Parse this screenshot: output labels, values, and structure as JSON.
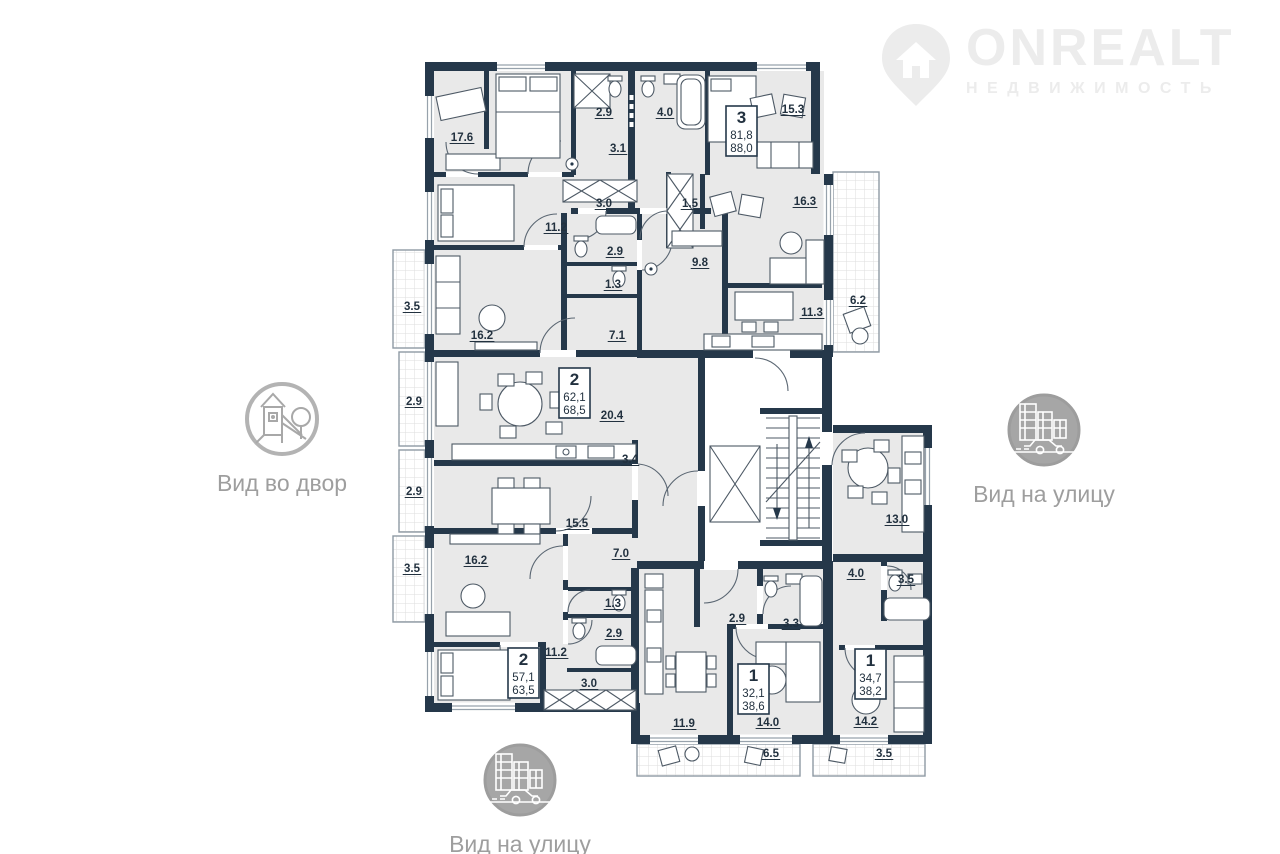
{
  "logo": {
    "brand": "ONREALT",
    "subtitle": "НЕДВИЖИМОСТЬ"
  },
  "views": {
    "courtyard": {
      "label": "Вид во двор"
    },
    "street_right": {
      "label": "Вид на улицу"
    },
    "street_bottom": {
      "label": "Вид на улицу"
    }
  },
  "plan": {
    "wall_color": "#25384a",
    "room_fill": "#e9e9e9",
    "room_labels": [
      {
        "t": "17.6",
        "x": 462,
        "y": 141
      },
      {
        "t": "2.9",
        "x": 604,
        "y": 116
      },
      {
        "t": "4.0",
        "x": 665,
        "y": 116
      },
      {
        "t": "15.3",
        "x": 793,
        "y": 113
      },
      {
        "t": "3.1",
        "x": 618,
        "y": 152
      },
      {
        "t": "3.0",
        "x": 604,
        "y": 207
      },
      {
        "t": "11.2",
        "x": 556,
        "y": 231
      },
      {
        "t": "1.5",
        "x": 690,
        "y": 207
      },
      {
        "t": "16.3",
        "x": 805,
        "y": 205
      },
      {
        "t": "2.9",
        "x": 615,
        "y": 255
      },
      {
        "t": "9.8",
        "x": 700,
        "y": 266
      },
      {
        "t": "1.3",
        "x": 613,
        "y": 288
      },
      {
        "t": "3.5",
        "x": 412,
        "y": 310
      },
      {
        "t": "16.2",
        "x": 482,
        "y": 339
      },
      {
        "t": "7.1",
        "x": 617,
        "y": 339
      },
      {
        "t": "11.3",
        "x": 812,
        "y": 316
      },
      {
        "t": "6.2",
        "x": 858,
        "y": 304
      },
      {
        "t": "2.9",
        "x": 414,
        "y": 405
      },
      {
        "t": "20.4",
        "x": 612,
        "y": 419
      },
      {
        "t": "3.4",
        "x": 630,
        "y": 463
      },
      {
        "t": "2.9",
        "x": 414,
        "y": 495
      },
      {
        "t": "15.5",
        "x": 577,
        "y": 527
      },
      {
        "t": "3.5",
        "x": 412,
        "y": 572
      },
      {
        "t": "16.2",
        "x": 476,
        "y": 564
      },
      {
        "t": "7.0",
        "x": 621,
        "y": 557
      },
      {
        "t": "13.0",
        "x": 897,
        "y": 523
      },
      {
        "t": "1.3",
        "x": 613,
        "y": 607
      },
      {
        "t": "2.9",
        "x": 614,
        "y": 637
      },
      {
        "t": "4.0",
        "x": 856,
        "y": 577
      },
      {
        "t": "3.5",
        "x": 906,
        "y": 583
      },
      {
        "t": "11.2",
        "x": 556,
        "y": 656
      },
      {
        "t": "3.0",
        "x": 589,
        "y": 687
      },
      {
        "t": "2.9",
        "x": 737,
        "y": 622
      },
      {
        "t": "3.3",
        "x": 791,
        "y": 627
      },
      {
        "t": "11.9",
        "x": 684,
        "y": 727
      },
      {
        "t": "14.0",
        "x": 768,
        "y": 726
      },
      {
        "t": "14.2",
        "x": 866,
        "y": 725
      },
      {
        "t": "6.5",
        "x": 771,
        "y": 757
      },
      {
        "t": "3.5",
        "x": 884,
        "y": 757
      }
    ],
    "unit_boxes": [
      {
        "num": "3",
        "a1": "81,8",
        "a2": "88,0",
        "x": 726,
        "y": 106
      },
      {
        "num": "2",
        "a1": "62,1",
        "a2": "68,5",
        "x": 559,
        "y": 368
      },
      {
        "num": "2",
        "a1": "57,1",
        "a2": "63,5",
        "x": 508,
        "y": 648
      },
      {
        "num": "1",
        "a1": "32,1",
        "a2": "38,6",
        "x": 738,
        "y": 664
      },
      {
        "num": "1",
        "a1": "34,7",
        "a2": "38,2",
        "x": 855,
        "y": 649
      }
    ]
  }
}
